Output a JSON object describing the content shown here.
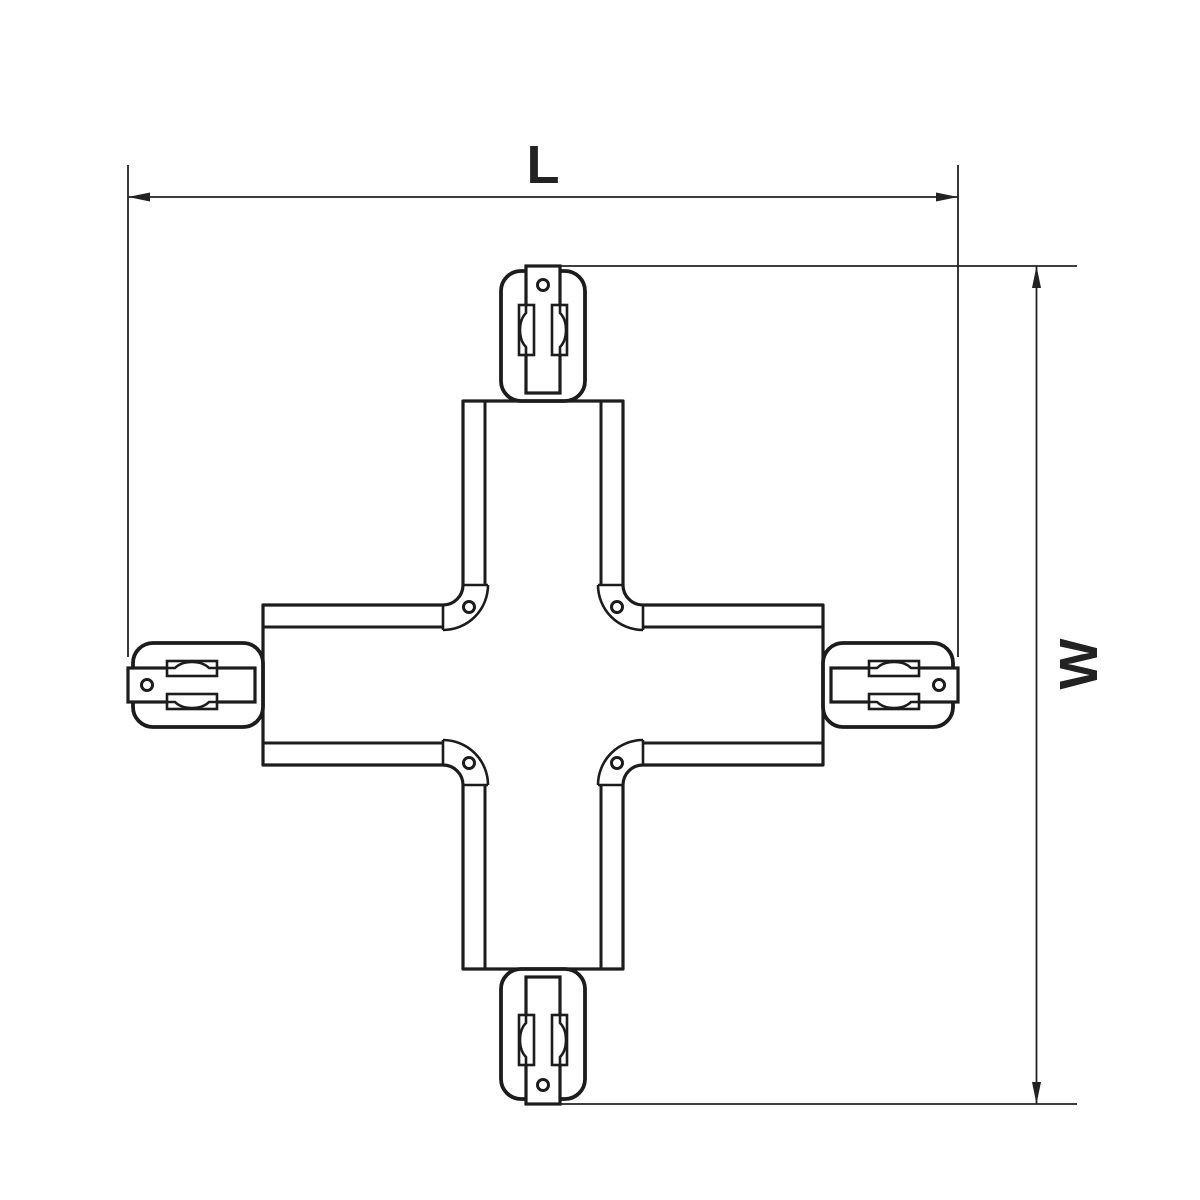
{
  "drawing": {
    "type": "technical-dimension-drawing",
    "subject": "x-shaped-track-connector",
    "dimensions": {
      "length_label": "L",
      "width_label": "W"
    },
    "colors": {
      "line": "#1c1c1c",
      "dimension": "#222222",
      "background": "#ffffff"
    }
  }
}
